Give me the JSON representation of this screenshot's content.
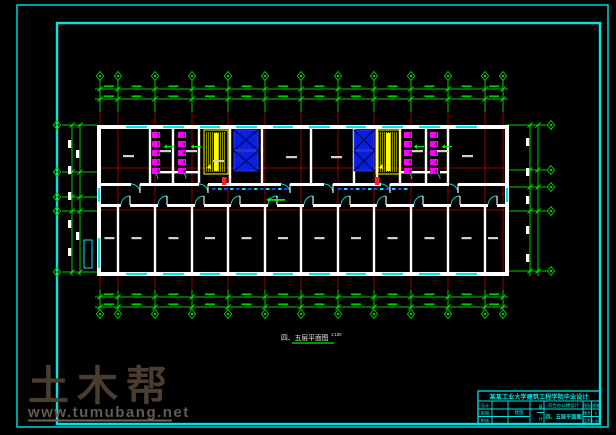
{
  "watermark": {
    "brand": "土木帮",
    "url": "www.tumubang.net"
  },
  "plan": {
    "caption": "四、五层平面图",
    "scale": "1:100"
  },
  "title_block": {
    "title": "某某工业大学建筑工程学院毕业设计",
    "project": "综合办公楼设计",
    "drawing_name": "四、五层平面图",
    "left_rows": [
      [
        "设计",
        ""
      ],
      [
        "制图",
        ""
      ],
      [
        "审核",
        ""
      ]
    ],
    "extra_cell": "建施",
    "narrow_cells": [
      "设",
      "计"
    ],
    "right_rows": [
      [
        "图别",
        "建施"
      ],
      [
        "图号",
        "8"
      ],
      [
        "比例",
        "1:100"
      ]
    ]
  },
  "colors": {
    "cyan": "#00e6e6",
    "green": "#00cc00",
    "bright_green": "#00ee00",
    "red": "#c00000",
    "bright_red": "#ff2222",
    "white": "#ffffff",
    "label_gray": "#cfcfcf",
    "magenta": "#ff00ff",
    "magenta_dark": "#550055",
    "yellow": "#ffff00",
    "blue_fill": "#0a1fe0",
    "blue_stroke": "#3344ff",
    "blue_dark": "#000a66",
    "wm_text": "#4a3c2e",
    "wm_url": "#625c52",
    "wm_line": "#6b655b"
  },
  "geometry": {
    "outer_border": [
      17,
      5,
      591,
      422
    ],
    "inner_border": [
      57,
      23,
      543,
      401
    ],
    "columns": [
      100,
      118,
      155,
      192,
      228,
      265,
      301,
      338,
      374,
      411,
      448,
      485,
      503
    ],
    "top_green_y": [
      80,
      112
    ],
    "bot_green_y": [
      290,
      310
    ],
    "red_y": [
      112,
      290
    ],
    "diamond_top_y": 76,
    "diamond_bot_y": 314,
    "top_dim_y": [
      89,
      99
    ],
    "bot_dim_y": [
      297,
      307
    ],
    "dim_x": [
      95,
      508
    ],
    "left_axes_y": [
      125,
      172,
      197,
      211,
      272
    ],
    "right_axes_y": [
      125,
      170,
      187,
      211,
      271
    ],
    "left_axis_x": [
      62,
      97
    ],
    "right_axis_x": [
      505,
      547
    ],
    "left_diamond_x": 57,
    "right_diamond_x": 551,
    "left_chain_x": [
      72,
      80
    ],
    "right_chain_x": [
      530,
      538
    ],
    "plan": {
      "l": 97,
      "r": 505,
      "t": 125,
      "b": 272,
      "w": 4,
      "ct": 183,
      "cb": 204,
      "cw": 3
    },
    "red_horiz_y": [
      168,
      210
    ],
    "north_partitions": [
      150,
      173,
      199,
      230,
      262,
      311,
      354,
      377,
      400,
      426,
      448
    ],
    "south_partitions": [
      118,
      155,
      192,
      228,
      265,
      301,
      338,
      374,
      411,
      448,
      485
    ],
    "window_bays": [
      1,
      2,
      3,
      4,
      5,
      6,
      7,
      8,
      9,
      10
    ],
    "left_wall_window_y": [
      238,
      268
    ],
    "corridor_end_window_y": [
      188,
      202
    ],
    "vestibules": [
      {
        "x1": 150,
        "x2": 199
      },
      {
        "x1": 400,
        "x2": 448
      }
    ],
    "vest_wall_y": 171,
    "vest_door_hinges": [
      158,
      186,
      412,
      440
    ],
    "north_door_hinges": [
      140,
      208,
      290,
      333,
      390,
      458
    ],
    "toilet_stall_cols": [
      152,
      178,
      404,
      430
    ],
    "green_arrows": [
      [
        167,
        146
      ],
      [
        194,
        146
      ],
      [
        417,
        146
      ],
      [
        445,
        146
      ]
    ],
    "stairs": [
      204,
      376
    ],
    "elevators": [
      {
        "x": 233,
        "w": 26
      },
      {
        "x": 353,
        "w": 22
      }
    ],
    "corridor_dashes": [
      [
        212,
        286
      ],
      [
        338,
        406
      ]
    ],
    "red_marks": [
      [
        222,
        177
      ],
      [
        375,
        177
      ]
    ],
    "north_labels": [
      [
        123,
        155
      ],
      [
        160,
        150
      ],
      [
        186,
        150
      ],
      [
        213,
        160
      ],
      [
        286,
        156
      ],
      [
        331,
        156
      ],
      [
        412,
        150
      ],
      [
        437,
        150
      ],
      [
        462,
        155
      ]
    ],
    "south_label_y": 237,
    "corridor_green": [
      270,
      199
    ],
    "left_entry": [
      84,
      240,
      8,
      28
    ],
    "right_chain_blob_y": [
      138,
      168,
      196,
      226,
      254
    ],
    "left_chain_blobs": [
      [
        68,
        140
      ],
      [
        68,
        166
      ],
      [
        68,
        192
      ],
      [
        68,
        220
      ],
      [
        68,
        248
      ],
      [
        76,
        150
      ],
      [
        76,
        232
      ]
    ]
  }
}
